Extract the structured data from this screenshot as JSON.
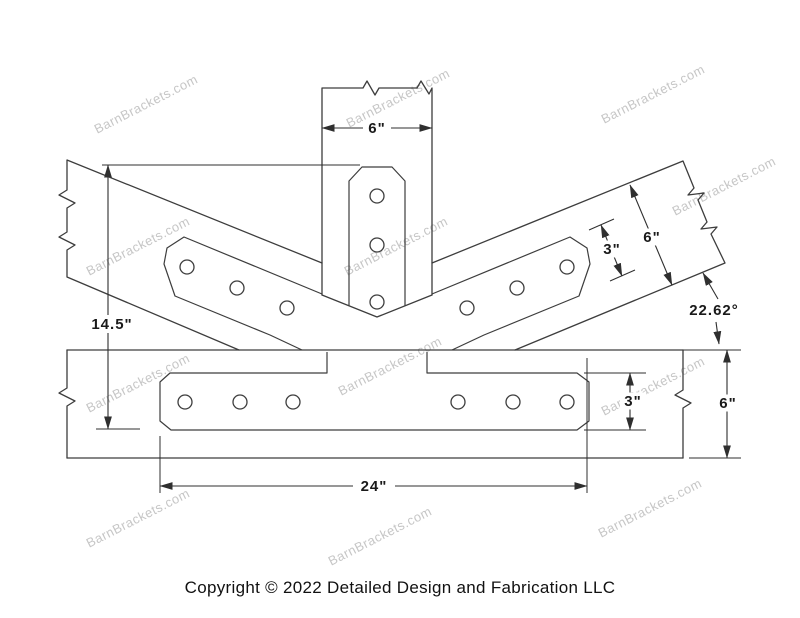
{
  "page": {
    "background": "#ffffff",
    "line_color": "#3d3d3d",
    "dimension_text_color": "#1a1a1a"
  },
  "footer": {
    "copyright": "Copyright © 2022 Detailed Design and Fabrication LLC"
  },
  "watermark": {
    "text": "BarnBrackets.com",
    "color": "#c6c6c6",
    "angle_deg": -27,
    "positions": [
      [
        148,
        108
      ],
      [
        400,
        102
      ],
      [
        655,
        98
      ],
      [
        140,
        250
      ],
      [
        398,
        250
      ],
      [
        726,
        190
      ],
      [
        140,
        387
      ],
      [
        392,
        370
      ],
      [
        655,
        390
      ],
      [
        140,
        522
      ],
      [
        382,
        540
      ],
      [
        652,
        512
      ]
    ]
  },
  "dimensions": [
    {
      "name": "post-width",
      "text": "6\"",
      "x": 377,
      "y": 128,
      "w": 28,
      "h": 17
    },
    {
      "name": "brace-plate-width",
      "text": "3\"",
      "x": 612,
      "y": 249,
      "w": 26,
      "h": 17
    },
    {
      "name": "brace-width",
      "text": "6\"",
      "x": 652,
      "y": 237,
      "w": 28,
      "h": 17
    },
    {
      "name": "brace-angle",
      "text": "22.62°",
      "x": 714,
      "y": 310,
      "w": 66,
      "h": 18
    },
    {
      "name": "overall-height",
      "text": "14.5\"",
      "x": 112,
      "y": 324,
      "w": 60,
      "h": 18
    },
    {
      "name": "beam-plate-width",
      "text": "3\"",
      "x": 633,
      "y": 401,
      "w": 26,
      "h": 17
    },
    {
      "name": "beam-width",
      "text": "6\"",
      "x": 728,
      "y": 403,
      "w": 28,
      "h": 17
    },
    {
      "name": "beam-plate-length",
      "text": "24\"",
      "x": 374,
      "y": 486,
      "w": 42,
      "h": 17
    }
  ]
}
